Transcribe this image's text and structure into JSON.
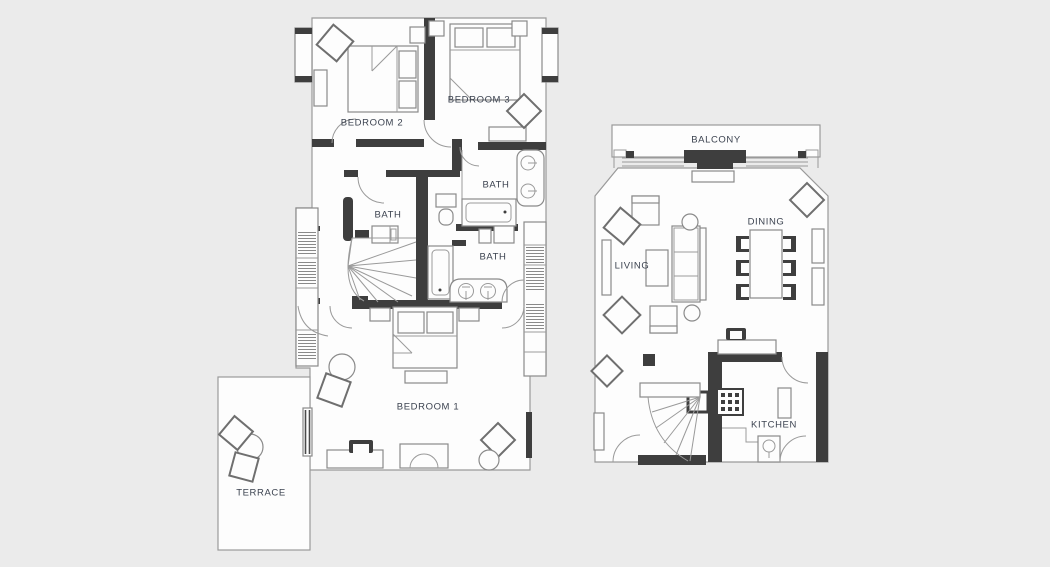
{
  "page": {
    "background": "#ebebeb"
  },
  "palette": {
    "wall_dark": "#3e3e3e",
    "line_gray": "#9a9a9a",
    "room_fill": "#fdfdfd",
    "label_color": "#3c4350"
  },
  "plans": {
    "upper_floor": {
      "rooms": {
        "bedroom2": "BEDROOM 2",
        "bedroom3": "BEDROOM 3",
        "bath_ensuite": "BATH",
        "bath_left": "BATH",
        "bath_lower": "BATH",
        "bedroom1": "BEDROOM 1",
        "terrace": "TERRACE"
      }
    },
    "main_floor": {
      "rooms": {
        "balcony": "BALCONY",
        "living": "LIVING",
        "dining": "DINING",
        "kitchen": "KITCHEN"
      }
    }
  }
}
